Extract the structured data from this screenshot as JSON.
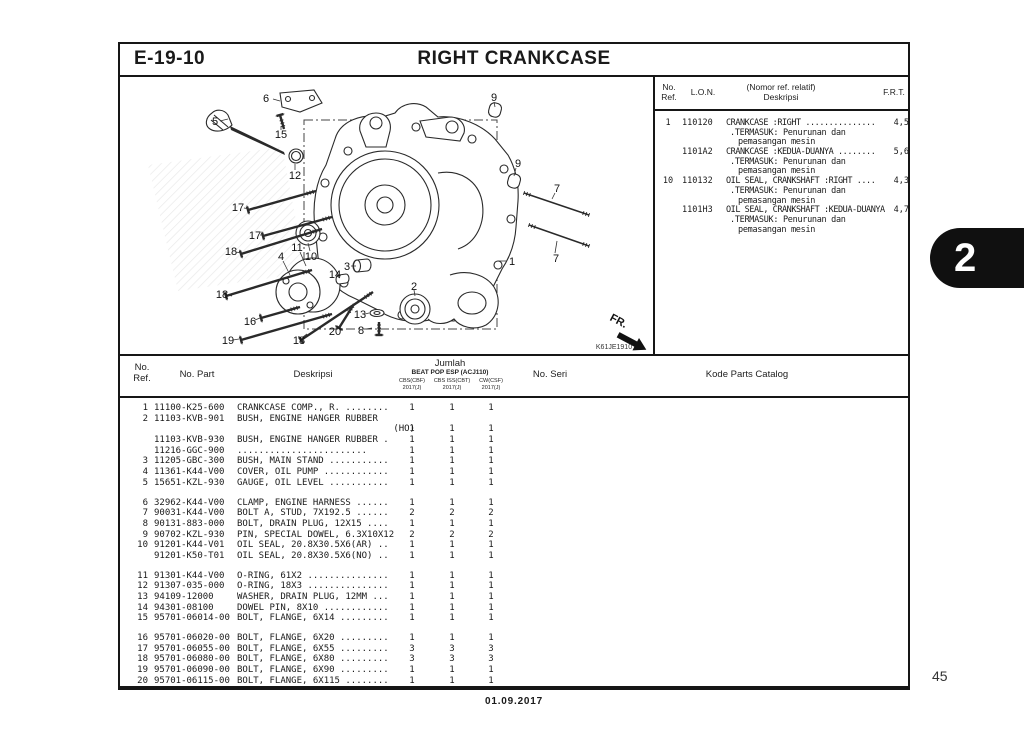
{
  "page": {
    "code": "E-19-10",
    "title": "RIGHT CRANKCASE",
    "section_tab": "2",
    "page_number": "45",
    "footer_date": "01.09.2017"
  },
  "ref_table": {
    "headers": {
      "ref_line1": "No.",
      "ref_line2": "Ref.",
      "lon": "L.O.N.",
      "desc_line1": "(Nomor ref. relatif)",
      "desc_line2": "Deskripsi",
      "frt": "F.R.T."
    },
    "rows": [
      {
        "ref": "1",
        "lon": "110120",
        "desc": "CRANKCASE :RIGHT ...............",
        "frt": "4,5",
        "sub1": ".TERMASUK: Penurunan dan",
        "sub2": "pemasangan mesin"
      },
      {
        "ref": "",
        "lon": "1101A2",
        "desc": "CRANKCASE :KEDUA-DUANYA ........",
        "frt": "5,6",
        "sub1": ".TERMASUK: Penurunan dan",
        "sub2": "pemasangan mesin"
      },
      {
        "ref": "10",
        "lon": "110132",
        "desc": "OIL SEAL, CRANKSHAFT :RIGHT ....",
        "frt": "4,3",
        "sub1": ".TERMASUK: Penurunan dan",
        "sub2": "pemasangan mesin"
      },
      {
        "ref": "",
        "lon": "1101H3",
        "desc": "OIL SEAL, CRANKSHAFT :KEDUA-DUANYA",
        "frt": "4,7",
        "sub1": ".TERMASUK: Penurunan dan",
        "sub2": "pemasangan mesin"
      }
    ]
  },
  "parts_table": {
    "headers": {
      "ref_line1": "No.",
      "ref_line2": "Ref.",
      "part": "No. Part",
      "desc": "Deskripsi",
      "jumlah": "Jumlah",
      "model": "BEAT POP ESP (ACJ110)",
      "col1": "CBS(CBF)",
      "col2": "CBS ISS(CBT)",
      "col3": "CW(CSF)",
      "year1": "2017(J)",
      "year2": "2017(J)",
      "year3": "2017(J)",
      "seri": "No. Seri",
      "kode": "Kode Parts Catalog"
    },
    "groups": [
      [
        {
          "ref": "1",
          "part": "11100-K25-600",
          "desc": "CRANKCASE COMP., R. ........",
          "q": [
            "1",
            "1",
            "1"
          ]
        },
        {
          "ref": "2",
          "part": "11103-KVB-901",
          "desc": "BUSH, ENGINE HANGER RUBBER",
          "q": [
            "",
            "",
            ""
          ]
        },
        {
          "ref": "",
          "part": "",
          "desc": "(HO)",
          "align": "r",
          "q": [
            "1",
            "1",
            "1"
          ]
        },
        {
          "ref": "",
          "part": "11103-KVB-930",
          "desc": "BUSH, ENGINE HANGER RUBBER .",
          "q": [
            "1",
            "1",
            "1"
          ]
        },
        {
          "ref": "",
          "part": "11216-GGC-900",
          "desc": "........................",
          "q": [
            "1",
            "1",
            "1"
          ]
        },
        {
          "ref": "3",
          "part": "11205-GBC-300",
          "desc": "BUSH, MAIN STAND ...........",
          "q": [
            "1",
            "1",
            "1"
          ]
        },
        {
          "ref": "4",
          "part": "11361-K44-V00",
          "desc": "COVER, OIL PUMP ............",
          "q": [
            "1",
            "1",
            "1"
          ]
        },
        {
          "ref": "5",
          "part": "15651-KZL-930",
          "desc": "GAUGE, OIL LEVEL ...........",
          "q": [
            "1",
            "1",
            "1"
          ]
        }
      ],
      [
        {
          "ref": "6",
          "part": "32962-K44-V00",
          "desc": "CLAMP, ENGINE HARNESS ......",
          "q": [
            "1",
            "1",
            "1"
          ]
        },
        {
          "ref": "7",
          "part": "90031-K44-V00",
          "desc": "BOLT A, STUD, 7X192.5 ......",
          "q": [
            "2",
            "2",
            "2"
          ]
        },
        {
          "ref": "8",
          "part": "90131-883-000",
          "desc": "BOLT, DRAIN PLUG, 12X15 ....",
          "q": [
            "1",
            "1",
            "1"
          ]
        },
        {
          "ref": "9",
          "part": "90702-KZL-930",
          "desc": "PIN, SPECIAL DOWEL, 6.3X10X12",
          "q": [
            "2",
            "2",
            "2"
          ]
        },
        {
          "ref": "10",
          "part": "91201-K44-V01",
          "desc": "OIL SEAL, 20.8X30.5X6(AR) ..",
          "q": [
            "1",
            "1",
            "1"
          ]
        },
        {
          "ref": "",
          "part": "91201-K50-T01",
          "desc": "OIL SEAL, 20.8X30.5X6(NO) ..",
          "q": [
            "1",
            "1",
            "1"
          ]
        }
      ],
      [
        {
          "ref": "11",
          "part": "91301-K44-V00",
          "desc": "O-RING, 61X2 ...............",
          "q": [
            "1",
            "1",
            "1"
          ]
        },
        {
          "ref": "12",
          "part": "91307-035-000",
          "desc": "O-RING, 18X3 ...............",
          "q": [
            "1",
            "1",
            "1"
          ]
        },
        {
          "ref": "13",
          "part": "94109-12000",
          "desc": "WASHER, DRAIN PLUG, 12MM ...",
          "q": [
            "1",
            "1",
            "1"
          ]
        },
        {
          "ref": "14",
          "part": "94301-08100",
          "desc": "DOWEL PIN, 8X10 ............",
          "q": [
            "1",
            "1",
            "1"
          ]
        },
        {
          "ref": "15",
          "part": "95701-06014-00",
          "desc": "BOLT, FLANGE, 6X14 .........",
          "q": [
            "1",
            "1",
            "1"
          ]
        }
      ],
      [
        {
          "ref": "16",
          "part": "95701-06020-00",
          "desc": "BOLT, FLANGE, 6X20 .........",
          "q": [
            "1",
            "1",
            "1"
          ]
        },
        {
          "ref": "17",
          "part": "95701-06055-00",
          "desc": "BOLT, FLANGE, 6X55 .........",
          "q": [
            "3",
            "3",
            "3"
          ]
        },
        {
          "ref": "18",
          "part": "95701-06080-00",
          "desc": "BOLT, FLANGE, 6X80 .........",
          "q": [
            "3",
            "3",
            "3"
          ]
        },
        {
          "ref": "19",
          "part": "95701-06090-00",
          "desc": "BOLT, FLANGE, 6X90 .........",
          "q": [
            "1",
            "1",
            "1"
          ]
        },
        {
          "ref": "20",
          "part": "95701-06115-00",
          "desc": "BOLT, FLANGE, 6X115 ........",
          "q": [
            "1",
            "1",
            "1"
          ]
        }
      ]
    ]
  },
  "diagram": {
    "fr_label": "FR.",
    "code": "K61JE1910",
    "callouts": [
      {
        "n": "6",
        "x": 146,
        "y": 21,
        "l": [
          153,
          22,
          160,
          24
        ]
      },
      {
        "n": "5",
        "x": 95,
        "y": 44,
        "l": [
          100,
          44,
          108,
          42
        ]
      },
      {
        "n": "15",
        "x": 161,
        "y": 57,
        "l": [
          161,
          53,
          161,
          49
        ]
      },
      {
        "n": "9",
        "x": 374,
        "y": 20,
        "l": [
          374,
          25,
          375,
          30
        ]
      },
      {
        "n": "12",
        "x": 175,
        "y": 98,
        "l": [
          175,
          93,
          175,
          87
        ]
      },
      {
        "n": "9",
        "x": 398,
        "y": 86,
        "l": [
          396,
          91,
          394,
          99
        ]
      },
      {
        "n": "7",
        "x": 437,
        "y": 111,
        "l": [
          435,
          116,
          432,
          122
        ]
      },
      {
        "n": "17",
        "x": 118,
        "y": 130,
        "l": [
          124,
          131,
          130,
          132
        ]
      },
      {
        "n": "17",
        "x": 135,
        "y": 158,
        "l": [
          140,
          158,
          145,
          158
        ]
      },
      {
        "n": "18",
        "x": 111,
        "y": 174,
        "l": [
          116,
          175,
          121,
          176
        ]
      },
      {
        "n": "11",
        "x": 177,
        "y": 170,
        "l": [
          180,
          175,
          186,
          189
        ]
      },
      {
        "n": "10",
        "x": 191,
        "y": 179,
        "l": [
          190,
          174,
          188,
          166
        ]
      },
      {
        "n": "4",
        "x": 161,
        "y": 179,
        "l": [
          163,
          184,
          170,
          198
        ]
      },
      {
        "n": "3",
        "x": 227,
        "y": 189,
        "l": [
          231,
          189,
          236,
          189
        ]
      },
      {
        "n": "14",
        "x": 215,
        "y": 197,
        "l": [
          217,
          199,
          220,
          201
        ]
      },
      {
        "n": "1",
        "x": 392,
        "y": 184,
        "l": [
          387,
          184,
          378,
          184
        ]
      },
      {
        "n": "7",
        "x": 436,
        "y": 181,
        "l": [
          435,
          176,
          437,
          164
        ]
      },
      {
        "n": "18",
        "x": 102,
        "y": 217,
        "l": [
          107,
          218,
          112,
          219
        ]
      },
      {
        "n": "2",
        "x": 294,
        "y": 209,
        "l": [
          294,
          213,
          295,
          219
        ]
      },
      {
        "n": "16",
        "x": 130,
        "y": 244,
        "l": [
          135,
          243,
          140,
          241
        ]
      },
      {
        "n": "13",
        "x": 240,
        "y": 237,
        "l": [
          245,
          237,
          249,
          236
        ]
      },
      {
        "n": "8",
        "x": 241,
        "y": 253,
        "l": [
          246,
          252,
          252,
          251
        ]
      },
      {
        "n": "20",
        "x": 215,
        "y": 254,
        "l": [
          218,
          251,
          221,
          247
        ]
      },
      {
        "n": "19",
        "x": 108,
        "y": 263,
        "l": [
          113,
          263,
          119,
          262
        ]
      },
      {
        "n": "18",
        "x": 179,
        "y": 263,
        "l": [
          183,
          260,
          187,
          257
        ]
      }
    ]
  }
}
